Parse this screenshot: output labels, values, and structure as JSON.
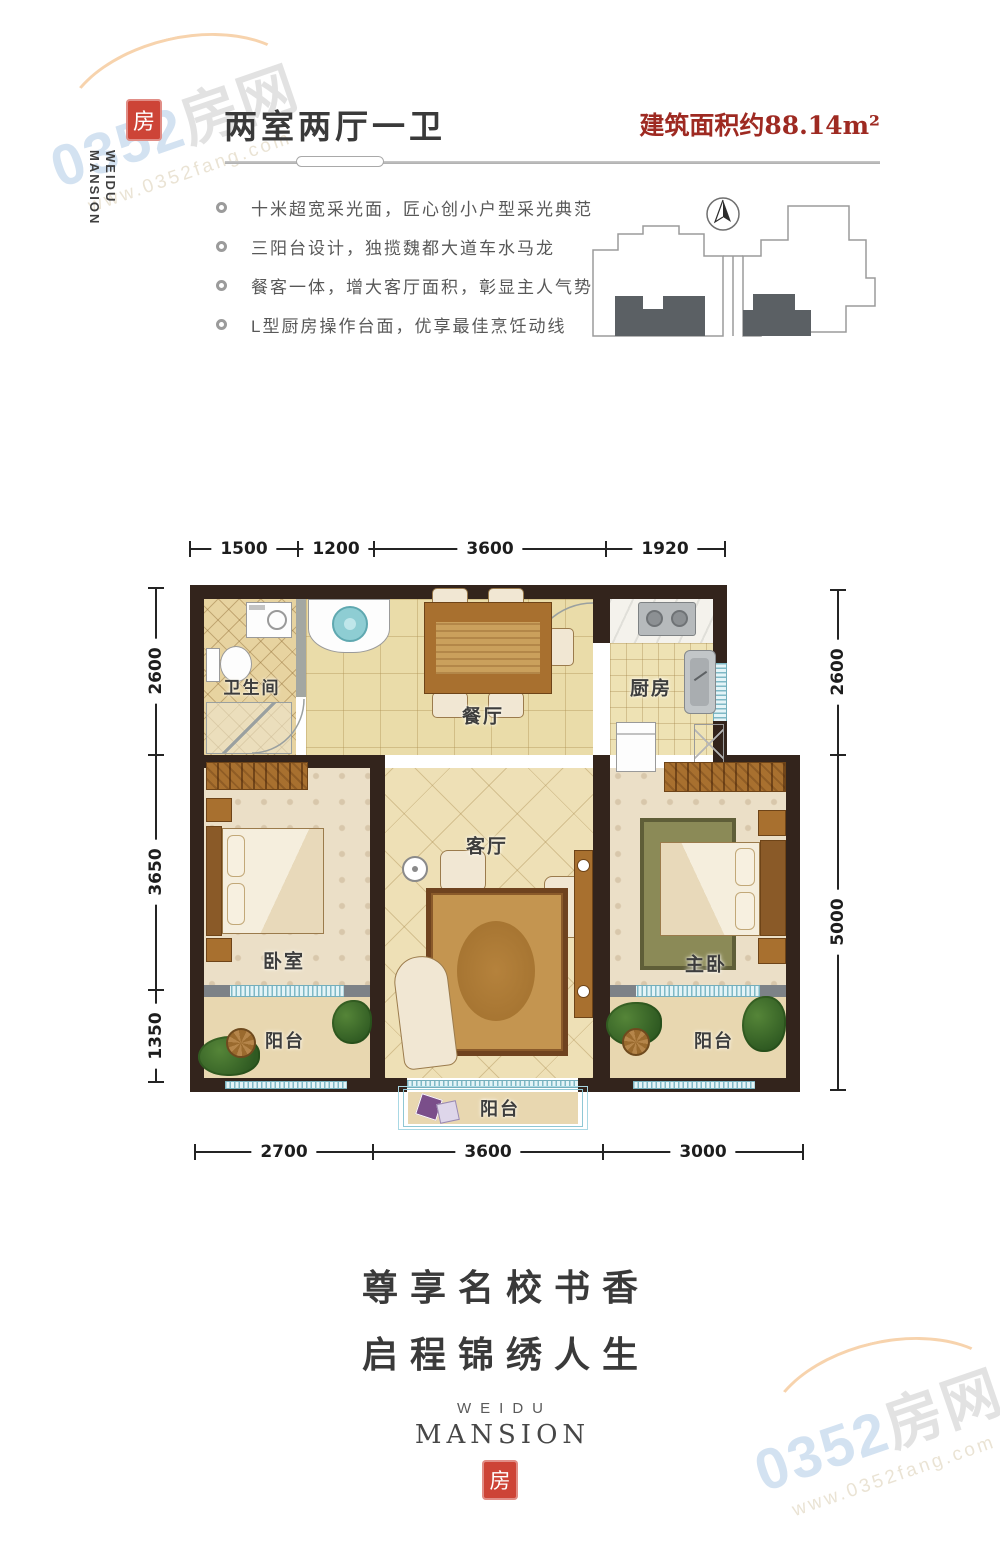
{
  "watermark": {
    "brand": "0352房网",
    "url": "www.0352fang.com"
  },
  "logo": {
    "seal_glyph": "房",
    "line1": "WEIDU",
    "line2": "MANSION"
  },
  "header": {
    "title": "两室两厅一卫",
    "area": "建筑面积约88.14m²"
  },
  "features": [
    "十米超宽采光面，匠心创小户型采光典范",
    "三阳台设计，独揽魏都大道车水马龙",
    "餐客一体，增大客厅面积，彰显主人气势",
    "L型厨房操作台面，优享最佳烹饪动线"
  ],
  "floor_plan": {
    "rooms": {
      "bathroom": "卫生间",
      "dining": "餐厅",
      "kitchen": "厨房",
      "bedroom": "卧室",
      "living": "客厅",
      "master": "主卧",
      "balcony_left": "阳台",
      "balcony_right": "阳台",
      "balcony_bottom": "阳台"
    },
    "dimensions": {
      "top": [
        "1500",
        "1200",
        "3600",
        "1920"
      ],
      "bottom": [
        "2700",
        "3600",
        "3000"
      ],
      "left": [
        "2600",
        "3650",
        "1350"
      ],
      "right": [
        "2600",
        "5000"
      ]
    }
  },
  "footer": {
    "slogan_line1": "尊享名校书香",
    "slogan_line2": "启程锦绣人生",
    "brand_line1": "WEIDU",
    "brand_line2": "MANSION",
    "seal_glyph": "房"
  },
  "colors": {
    "accent_red": "#9e2a22",
    "seal_red": "#cd4437",
    "wall_dark": "#33241c",
    "window_cyan": "#bfe3ec",
    "floor_beige": "#eadca9"
  }
}
